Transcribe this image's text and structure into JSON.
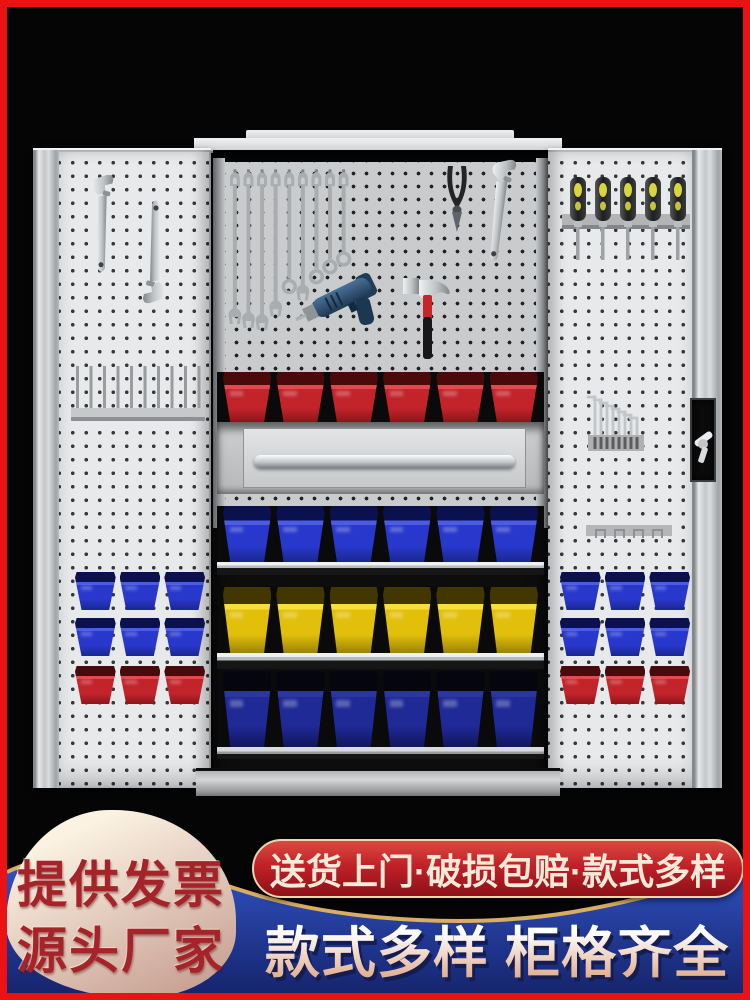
{
  "frame": {
    "border_color": "#ea1212",
    "background_color": "#050505"
  },
  "cabinet": {
    "body_color": "#d8dadc",
    "door_pegboard_color": "#e7e9eb",
    "interior_pegboard_color": "#c9cbcd",
    "tools": [
      {
        "name": "adjustable-wrench",
        "count": 3
      },
      {
        "name": "combination-wrench",
        "count": 9
      },
      {
        "name": "diagonal-pliers",
        "count": 1
      },
      {
        "name": "power-drill",
        "count": 1
      },
      {
        "name": "claw-hammer",
        "count": 1
      },
      {
        "name": "screwdriver",
        "count": 5
      },
      {
        "name": "hex-key",
        "count": 8
      }
    ],
    "wrench_set": {
      "count": 9,
      "lengths": [
        170,
        174,
        176,
        162,
        132,
        146,
        122,
        112,
        104
      ],
      "ends": [
        "open",
        "open",
        "open",
        "open",
        "ring",
        "open",
        "ring",
        "ring",
        "ring"
      ]
    },
    "screwdriver_set": {
      "count": 5
    },
    "hex_key_set": {
      "count": 8
    },
    "peg_rack": {
      "pins": 10
    },
    "clip_rail": {
      "clips": 4
    },
    "interior_rows": {
      "red": {
        "name": "red-bins-row",
        "count": 6,
        "top": "#4a0a0c",
        "lip": "#e0494e",
        "face": "#c2242a",
        "dark": "#8c161b"
      },
      "blue": {
        "name": "blue-bins-row",
        "count": 6,
        "top": "#0a1050",
        "lip": "#4b5ce0",
        "face": "#2838cc",
        "dark": "#1a278f"
      },
      "yellow": {
        "name": "yellow-bins-row",
        "count": 6,
        "top": "#423700",
        "lip": "#f7df3a",
        "face": "#e2bf0a",
        "dark": "#9a8206"
      },
      "navy": {
        "name": "navy-bins-row",
        "count": 6,
        "top": "#05050f",
        "lip": "#2b379e",
        "face": "#1f2a96",
        "dark": "#10165c"
      }
    },
    "door_rows": {
      "blue": {
        "name": "door-blue-row",
        "count": 3,
        "top": "#0a1050",
        "lip": "#4b5ce0",
        "face": "#2838cc",
        "dark": "#1a278f"
      },
      "red": {
        "name": "door-red-row",
        "count": 3,
        "top": "#4a0a0c",
        "lip": "#e0494e",
        "face": "#c2242a",
        "dark": "#8c161b"
      }
    }
  },
  "promo": {
    "left_badge": {
      "line1": "提供发票",
      "line2": "源头厂家",
      "text_color": "#a6232a",
      "blob_from": "#fbf2e2",
      "blob_to": "#c59c8f"
    },
    "shipping_pill": {
      "text": "送货上门·破损包赔·款式多样",
      "text_color": "#f7ead8",
      "bg_from": "#da4a41",
      "bg_mid": "#c12028",
      "bg_to": "#8d1117",
      "outline_color": "#ecd7ae"
    },
    "headline": {
      "text": "款式多样 柜格齐全",
      "fill_from": "#ffffff",
      "fill_to": "#dfa784",
      "shadow_color": "#131d52"
    },
    "band": {
      "blue_from": "#3156c8",
      "blue_to": "#16246d",
      "gold": "#d9ae63"
    }
  }
}
